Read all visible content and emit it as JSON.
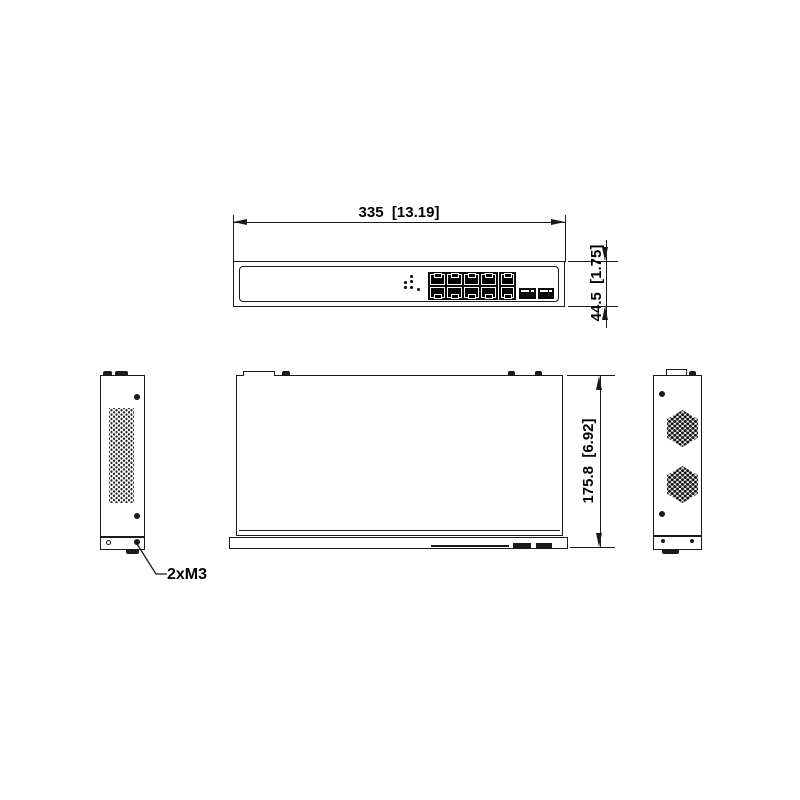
{
  "labels": {
    "width": "335  [13.19]",
    "height": "44.5  [1.75]",
    "depth": "175.8  [6.92]",
    "screws": "2xM3"
  },
  "colors": {
    "line": "#1a1a1a",
    "background": "#ffffff",
    "port_fill": "#0a0a0a"
  },
  "front_panel": {
    "led_indicators": 6,
    "rj45_ports": 8,
    "uplink_rj45_ports": 2,
    "sfp_ports": 2
  }
}
